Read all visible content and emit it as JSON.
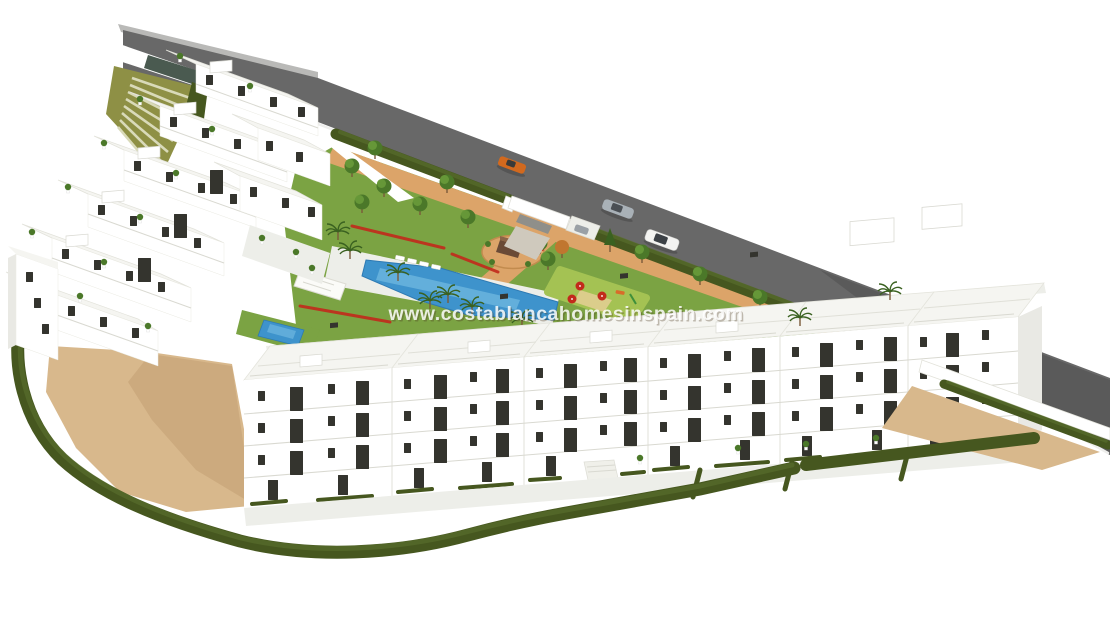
{
  "watermark": {
    "text": "www.costablancahomesinspain.com"
  },
  "scene": {
    "description": "Aerial 3D architect's render of a white Mediterranean apartment development: a terraced hillside block on the left, an L-shaped row of flat-roofed four-storey apartment buildings along the bottom, and a communal garden with a large swimming pool, lawns, palm trees, a circular plaza and a playground. A diagonal road with three cars and an entrance gate runs along the top, and a curved dark hedge encloses sandy ground around the plot.",
    "objects": {
      "road": "asphalt road with white curb",
      "cars": [
        "orange car",
        "silver car",
        "white suv"
      ],
      "entrance": "white entrance canopy with ramp",
      "stairs": "wide garden staircase on green slope",
      "pools": [
        "main swimming pool",
        "small plunge pool"
      ],
      "playground": "play area with red umbrellas",
      "plaza": "circular plaza with monument sign"
    }
  },
  "colors": {
    "bg": "#ffffff",
    "road": "#686868",
    "road_dark": "#5a5a5a",
    "curb": "#eeeeec",
    "sidewalk": "#b9b9b7",
    "hedge": "#46571f",
    "hedge_light": "#5c7330",
    "lawn": "#7ba343",
    "playground": "#a4c253",
    "path": "#dca469",
    "sand": "#d8b88c",
    "sand_shade": "#c29f72",
    "pool": "#3e93cc",
    "pool_light": "#82c6e8",
    "bld": "#ffffff",
    "bld_shade": "#e9e9e4",
    "roof": "#f5f5f1",
    "roofline": "#e0e0d8",
    "tile": "#edeee9",
    "win": "#34342e",
    "slope": "#8e9045",
    "step": "#d9dab9",
    "wall_dark": "#4a5a50",
    "tree_dark": "#4b7829",
    "tree_light": "#699a3a",
    "palm": "#3a6120",
    "trunk": "#7a5a3a",
    "flower": "#c22a1c",
    "orange_tree": "#c0762f",
    "monument": "#6a4a36",
    "car_orange": "#d2691e",
    "car_silver": "#a9b1b7",
    "car_white": "#f3f3f1"
  }
}
